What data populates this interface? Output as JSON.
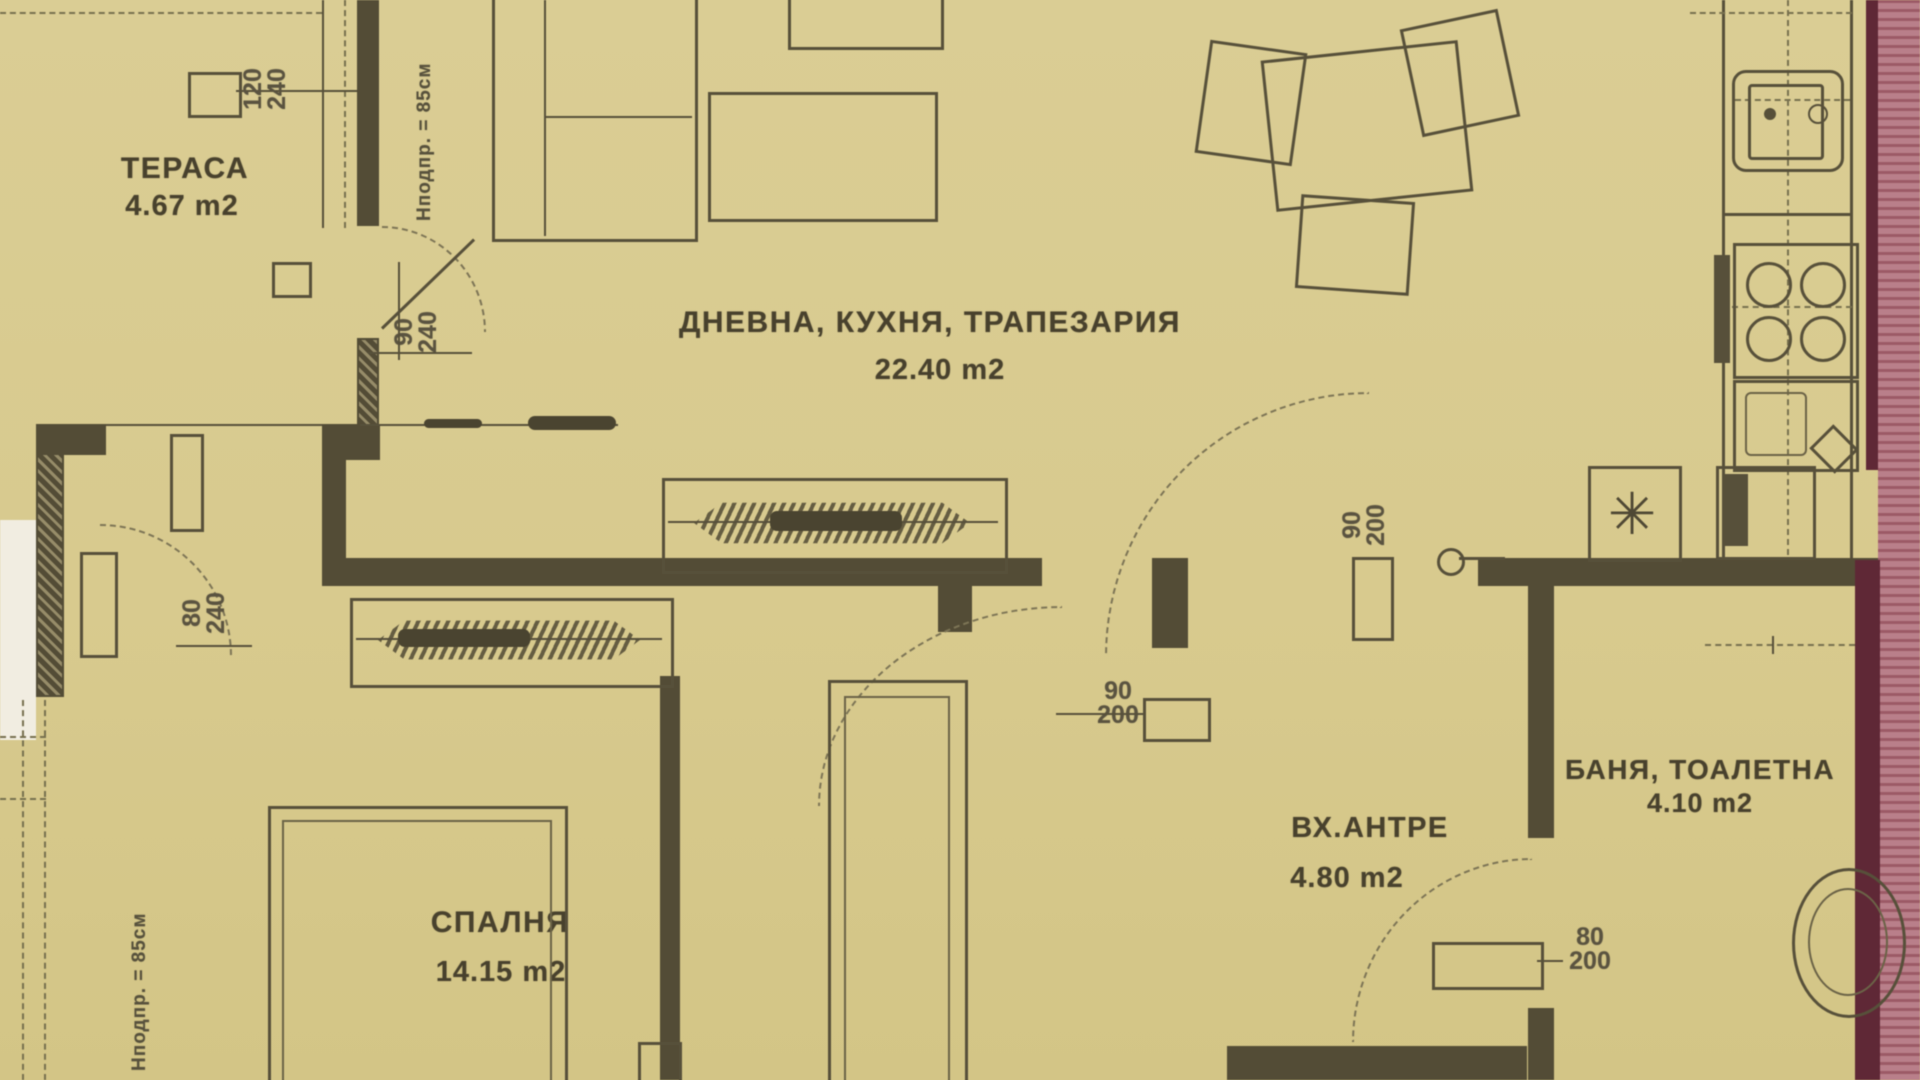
{
  "colors": {
    "paper": "#d8ca8e",
    "ink": "#4f4834",
    "wall": "#534c36",
    "pink_exterior_wall": "#b97f8a",
    "maroon_wall_edge": "#5f2836",
    "white_margin": "#f1ede1"
  },
  "rooms": [
    {
      "id": "terrace",
      "name": "ТЕРАСА",
      "area": "4.67 m2"
    },
    {
      "id": "living",
      "name": "ДНЕВНА, КУХНЯ, ТРАПЕЗАРИЯ",
      "area": "22.40 m2"
    },
    {
      "id": "bedroom",
      "name": "СПАЛНЯ",
      "area": "14.15 m2"
    },
    {
      "id": "hall",
      "name": "ВХ.АНТРЕ",
      "area": "4.80 m2"
    },
    {
      "id": "bath",
      "name": "БАНЯ, ТОАЛЕТНА",
      "area": "4.10 m2"
    }
  ],
  "openings": [
    {
      "id": "terrace-window",
      "w": "120",
      "h": "240"
    },
    {
      "id": "living-terrace-door",
      "w": "90",
      "h": "240"
    },
    {
      "id": "bedroom-terrace-door",
      "w": "80",
      "h": "240"
    },
    {
      "id": "entry-door",
      "w": "90",
      "h": "200"
    },
    {
      "id": "bedroom-door",
      "w": "90",
      "h": "200"
    },
    {
      "id": "bathroom-door",
      "w": "80",
      "h": "200"
    }
  ],
  "annotations": {
    "sill_top": "Нподпр. = 85см",
    "sill_left": "Нподпр. = 85см"
  },
  "icons": {
    "fridge": "✳"
  }
}
